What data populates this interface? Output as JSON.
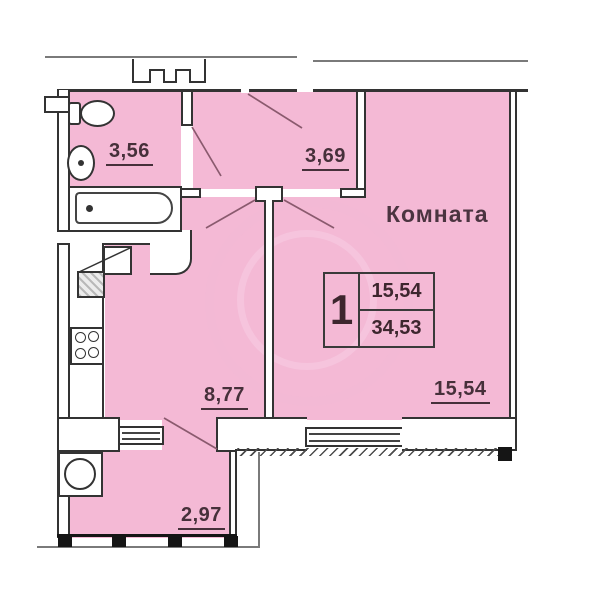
{
  "plan": {
    "room_label": "Комната",
    "areas": {
      "bathroom": "3,56",
      "hallway": "3,69",
      "living_room": "15,54",
      "kitchen": "8,77",
      "balcony": "2,97"
    },
    "info_box": {
      "rooms_count": "1",
      "living_area": "15,54",
      "total_area": "34,53"
    },
    "colors": {
      "room_fill": "#f4b9d5",
      "wall_line": "#333333",
      "label_text": "#46303a",
      "outline_gray": "#7a7a7a"
    }
  }
}
